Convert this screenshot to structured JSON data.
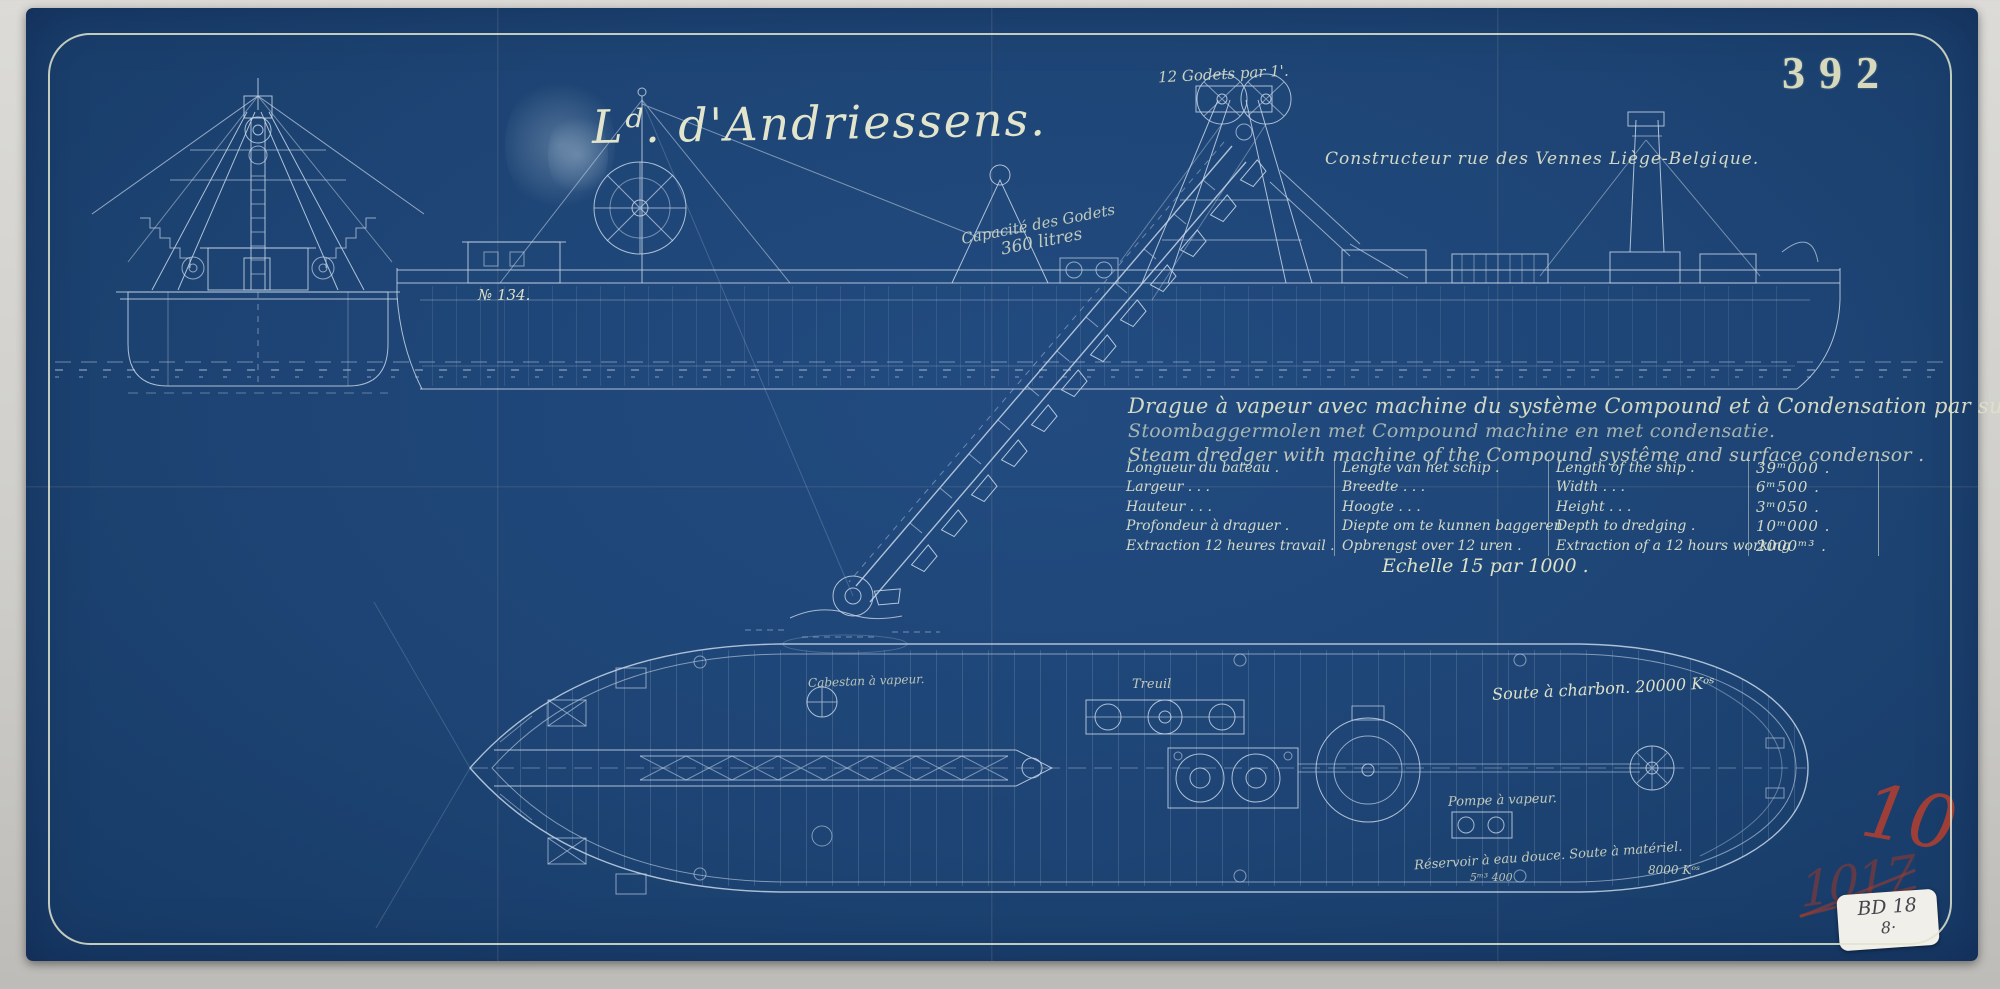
{
  "drawing_number": "392",
  "header": {
    "title": "Lᵈ. d'Andriessens.",
    "builder": "Constructeur rue des Vennes Liège-Belgique."
  },
  "side_view_labels": {
    "bucket_rate": "12 Godets par 1'.",
    "bucket_capacity_line1": "Capacité des Godets",
    "bucket_capacity_line2": "360 litres",
    "hull_number": "№ 134."
  },
  "description_lines": {
    "french": "Drague à vapeur avec machine du système Compound et à Condensation par surface.",
    "dutch": "Stoombaggermolen met Compound machine en met condensatie.",
    "english": "Steam dredger with machine of the Compound systême and surface condensor ."
  },
  "spec_table": {
    "rows": [
      {
        "fr": "Longueur du bateau .",
        "nl": "Lengte van het schip .",
        "en": "Length of the ship .",
        "value": "39ᵐ000 ."
      },
      {
        "fr": "Largeur .   .   .",
        "nl": "Breedte .   .   .",
        "en": "Width .   .   .",
        "value": "6ᵐ500 ."
      },
      {
        "fr": "Hauteur .   .   .",
        "nl": "Hoogte .   .   .",
        "en": "Height .   .   .",
        "value": "3ᵐ050 ."
      },
      {
        "fr": "Profondeur à draguer .",
        "nl": "Diepte om te kunnen baggeren",
        "en": "Depth to dredging .",
        "value": "10ᵐ000 ."
      },
      {
        "fr": "Extraction 12 heures travail .",
        "nl": "Opbrengst over 12 uren .",
        "en": "Extraction of a 12 hours working",
        "value": "2000ᵐ³ ."
      }
    ]
  },
  "scale_note": "Echelle 15 par 1000 .",
  "plan_view_labels": {
    "coal_bunker": "Soute à charbon. 20000 Kᵒˢ",
    "winch": "Treuil",
    "capstan": "Cabestan à vapeur.",
    "steam_pump": "Pompe à vapeur.",
    "reservoir": "Réservoir à eau douce. Soute à matériel.",
    "reservoir_volume": "5ᵐ³ 400",
    "material_weight": "8000 Kᵒˢ"
  },
  "stamps": {
    "red_number": "10",
    "red_scribble": "1017",
    "sticker_line1": "BD 18",
    "sticker_line2": "8·"
  },
  "colors": {
    "paper_blue": "#1d4474",
    "ink_cream": "#dde1c8",
    "line_pale": "#c7d6e8",
    "stamp_red": "#b5402f"
  }
}
